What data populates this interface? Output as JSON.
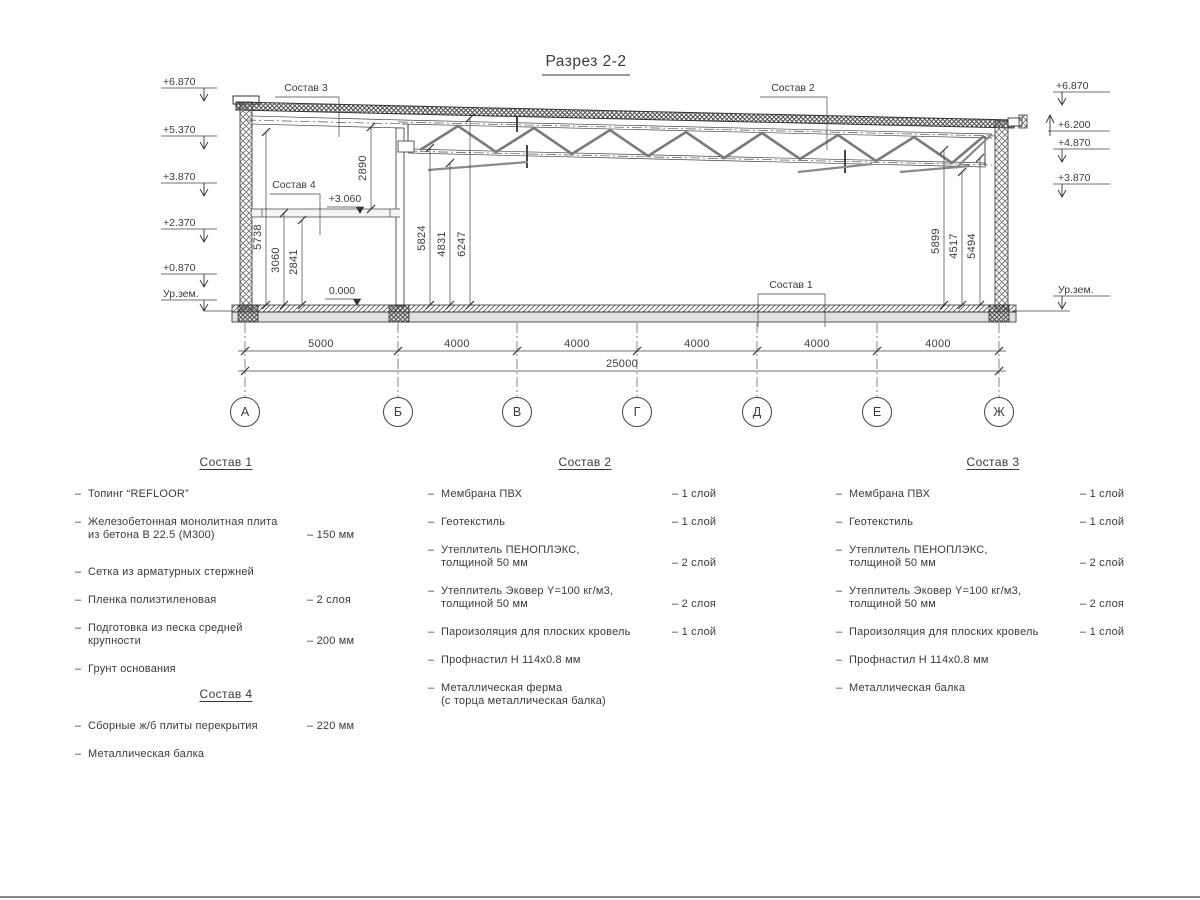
{
  "title": "Разрез 2-2",
  "colors": {
    "line": "#444444",
    "text": "#3b3b3b",
    "slab_fill": "#e0e0e0",
    "background": "#ffffff"
  },
  "misc": {
    "dash": "–"
  },
  "drawing": {
    "elev_left": [
      "+6.870",
      "+5.370",
      "+3.870",
      "+2.370",
      "+0.870",
      "Ур.зем."
    ],
    "elev_right": [
      "+6.870",
      "+6.200",
      "+4.870",
      "+3.870",
      "Ур.зем."
    ],
    "mark_mezzanine": "+3.060",
    "mark_floor": "0.000",
    "callouts": {
      "c1": "Состав 1",
      "c2": "Состав 2",
      "c3": "Состав 3",
      "c4": "Состав 4"
    },
    "vdims": [
      "2890",
      "5738",
      "3060",
      "2841",
      "5824",
      "4831",
      "6247",
      "5899",
      "4517",
      "5494"
    ],
    "hdims": [
      "5000",
      "4000",
      "4000",
      "4000",
      "4000",
      "4000"
    ],
    "total_dim": "25000",
    "axes": [
      "А",
      "Б",
      "В",
      "Г",
      "Д",
      "Е",
      "Ж"
    ]
  },
  "lists": [
    {
      "title": "Состав 1",
      "items": [
        {
          "t1": "Топинг “REFLOOR”",
          "v": ""
        },
        {
          "t1": "Железобетонная  монолитная плита",
          "t2": "из бетона В 22.5 (М300)",
          "v": "– 150 мм"
        },
        {
          "t1": "Сетка из арматурных стержней",
          "v": ""
        },
        {
          "t1": "Пленка полиэтиленовая",
          "v": "– 2 слоя"
        },
        {
          "t1": "Подготовка из песка средней",
          "t2": "крупности",
          "v": "– 200 мм"
        },
        {
          "t1": "Грунт основания",
          "v": ""
        }
      ]
    },
    {
      "title": "Состав 2",
      "items": [
        {
          "t1": "Мембрана ПВХ",
          "v": "– 1 слой"
        },
        {
          "t1": "Геотекстиль",
          "v": "– 1 слой"
        },
        {
          "t1": "Утеплитель ПЕНОПЛЭКС,",
          "t2": "толщиной 50 мм",
          "v": "– 2 слой"
        },
        {
          "t1": "Утеплитель Эковер Y=100 кг/м3,",
          "t2": "толщиной 50 мм",
          "v": "– 2 слоя"
        },
        {
          "t1": "Пароизоляция для плоских кровель",
          "v": "– 1 слой"
        },
        {
          "t1": "Профнастил Н 114х0.8 мм",
          "v": ""
        },
        {
          "t1": "Металлическая ферма",
          "t2": "(с торца металлическая балка)",
          "v": ""
        }
      ]
    },
    {
      "title": "Состав 3",
      "items": [
        {
          "t1": "Мембрана ПВХ",
          "v": "– 1 слой"
        },
        {
          "t1": "Геотекстиль",
          "v": "– 1 слой"
        },
        {
          "t1": "Утеплитель ПЕНОПЛЭКС,",
          "t2": "толщиной 50 мм",
          "v": "– 2 слой"
        },
        {
          "t1": "Утеплитель Эковер Y=100 кг/м3,",
          "t2": "толщиной 50 мм",
          "v": "– 2 слоя"
        },
        {
          "t1": "Пароизоляция для плоских кровель",
          "v": "– 1 слой"
        },
        {
          "t1": "Профнастил Н 114х0.8 мм",
          "v": ""
        },
        {
          "t1": "Металлическая балка",
          "v": ""
        }
      ]
    },
    {
      "title": "Состав 4",
      "items": [
        {
          "t1": "Сборные ж/б плиты перекрытия",
          "v": "– 220 мм"
        },
        {
          "t1": "Металлическая балка",
          "v": ""
        }
      ]
    }
  ]
}
